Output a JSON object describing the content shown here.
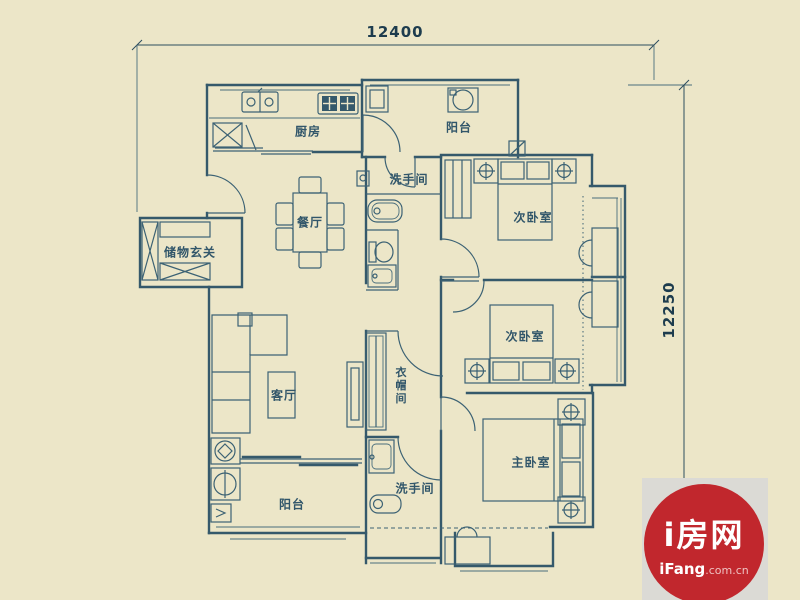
{
  "dimensions": {
    "top": "12400",
    "right": "12250"
  },
  "rooms": {
    "kitchen": "厨房",
    "balcony_top": "阳台",
    "bathroom_top": "洗手间",
    "bedroom_second_a": "次卧室",
    "dining": "餐厅",
    "storage_entry": "储物玄关",
    "bedroom_second_b": "次卧室",
    "living": "客厅",
    "cloakroom": "衣帽间",
    "master_bedroom": "主卧室",
    "balcony_bottom": "阳台",
    "bathroom_bottom": "洗手间"
  },
  "logo": {
    "name": "i房网",
    "site": "iFang",
    "suffix": ".com.cn"
  },
  "colors": {
    "background": "#ece6c8",
    "line": "#35596b",
    "dimension": "#1d3c4e",
    "logo_red": "#c1272d",
    "logo_patch": "#dbdad5"
  }
}
